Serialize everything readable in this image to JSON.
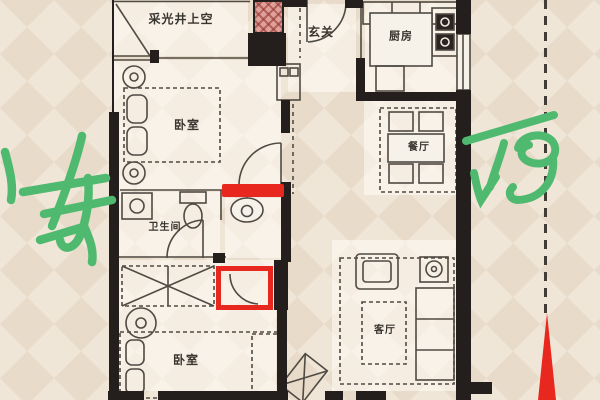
{
  "floorplan": {
    "rooms": {
      "light_well": "采光井上空",
      "entry": "玄关",
      "kitchen": "厨房",
      "bedroom_top": "卧室",
      "dining": "餐厅",
      "bathroom": "卫生间",
      "bedroom_bottom": "卧室",
      "living": "客厅"
    },
    "annotations": {
      "east": "东",
      "west": "西"
    },
    "colors": {
      "annotation_green": "#4fba6f",
      "highlight_red": "#e8281e",
      "wall_black": "#241f1c",
      "floor_wash": "#f4efe7",
      "background": "#ebdfd0",
      "shaft_pink": "#dfa09a"
    }
  }
}
